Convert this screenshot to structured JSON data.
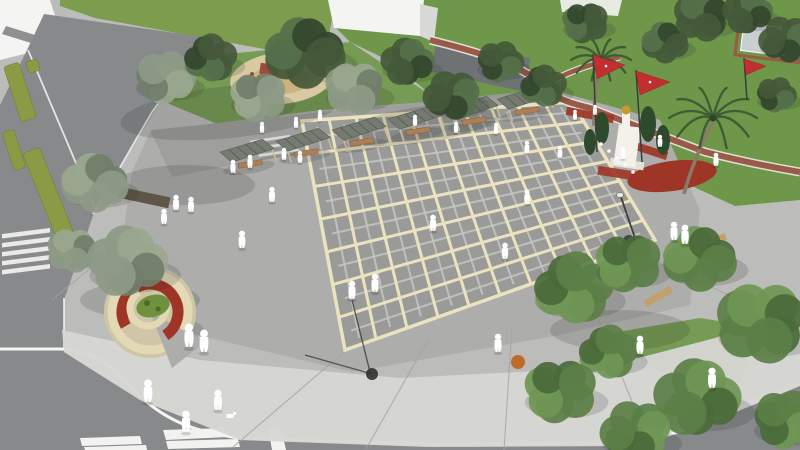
{
  "scene": {
    "type": "3D architectural rendering",
    "view": "aerial perspective",
    "subject": "Urban public square and park landscape design visualization",
    "notes": "Large paved plaza with cream grid pattern, pergola seating row, children's playground, lawn park with winding red jogging track, palm trees, red flags, white monument with golden bust, spiral flower planter, scattered white human figures, surrounding streets with crosswalks"
  },
  "palette": {
    "pavement_base": "#bcbcba",
    "pavement_light": "#d6d6d3",
    "pavement_mid": "#adadab",
    "walkway_gray": "#9c9c9a",
    "plaza_cell": "#9a9b99",
    "plaza_grid_line": "#ebe2bf",
    "plaza_subline": "#c6c7c5",
    "joint_line": "#a3a3a1",
    "road_asphalt": "#87898b",
    "road_marking": "#f2f2f0",
    "curb_white": "#f5f5f3",
    "lawn_light": "#7d9c4e",
    "lawn_park": "#6e9749",
    "hedge_olive": "#8b9a44",
    "tree_dark": "#44593a",
    "tree_bright": "#5b7f46",
    "tree_sage": "#8d9a86",
    "palm_green": "#3f5d35",
    "trunk_brown": "#8a7a66",
    "track_red": "#9a5a47",
    "flower_red": "#9e3526",
    "flower_orange": "#c06a28",
    "flag_red": "#c32f2f",
    "playground_sand": "#d9c9a2",
    "play_equipment_red": "#9c4a3a",
    "play_slide_yellow": "#edb43a",
    "planter_cream": "#e3d9b4",
    "planter_base": "#cfc6a8",
    "planter_green": "#6f913d",
    "bench_wood": "#c2a06b",
    "bench_wall": "#5f5648",
    "pergola_slat": "#757b70",
    "pergola_post": "#cbb896",
    "building_white": "#f4f4f2",
    "building_roof": "#8e9092",
    "building_shade": "#d8d8d6",
    "building_dark": "#6f7275",
    "monument_white": "#f3f1ea",
    "bust_gold": "#c9992e",
    "cypress_green": "#2e4a2c",
    "court_gray": "#c9cfd0",
    "figure_white": "#fdfdfd",
    "lamp_dark": "#3c3f3c",
    "shadow": "rgba(40,45,40,0.16)"
  },
  "plaza": {
    "grid_cols": 10,
    "grid_rows": 7
  },
  "inventory": {
    "figures": 37,
    "trees": 27,
    "palm_trees": 2,
    "pergolas": 6,
    "flags": 3,
    "street_lamps": 2,
    "buildings": 4,
    "edge_benches": 3,
    "crosswalks": 2,
    "playgrounds": 1,
    "monuments": 1,
    "spiral_planters": 1
  }
}
